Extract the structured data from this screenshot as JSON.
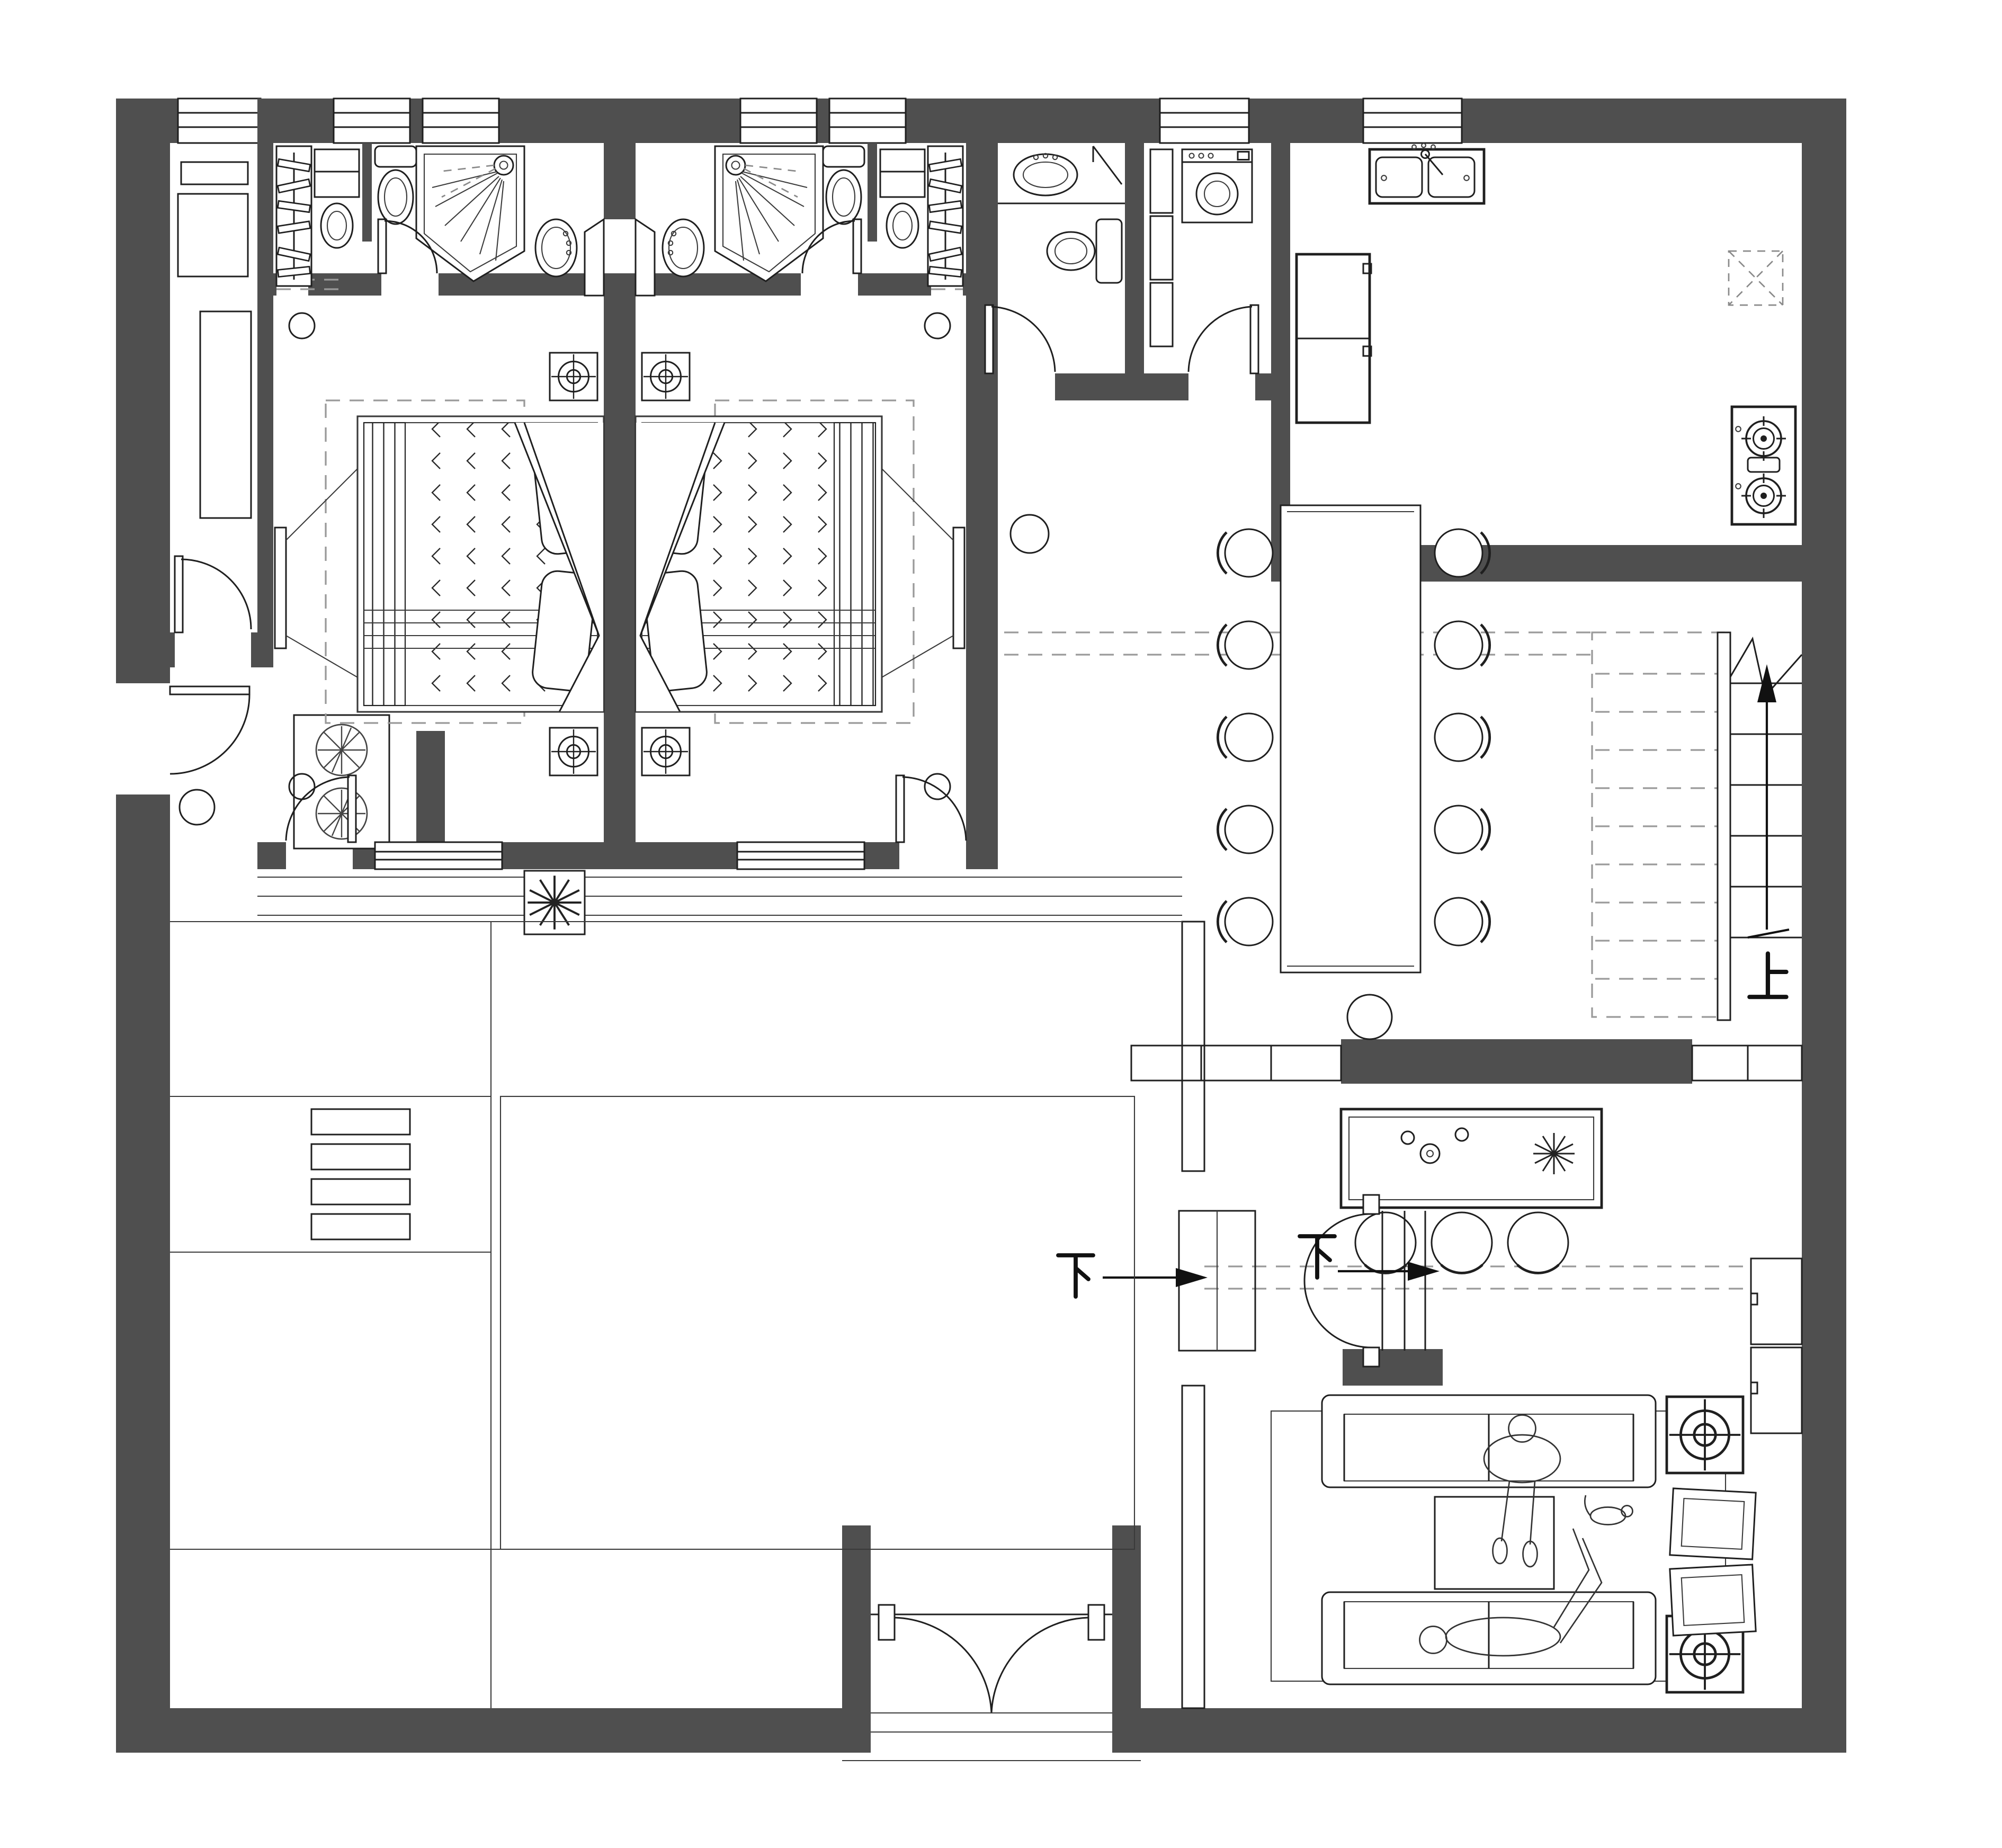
{
  "title": "Residential ground floor plan",
  "drawing_type": "architectural-floor-plan",
  "palette": {
    "wall": "#4f4f4f",
    "line": "#1f1f1f",
    "light_line": "#9a9a9a",
    "background": "#ffffff"
  },
  "labels": {
    "stairs_up": "上",
    "stairs_down": "下"
  },
  "annotations": [
    {
      "name": "stairs-up-arrow",
      "label": "上",
      "direction": "up"
    },
    {
      "name": "stairs-down-arrow-west",
      "label": "下",
      "direction": "down"
    },
    {
      "name": "stairs-down-arrow-east",
      "label": "下",
      "direction": "down"
    }
  ],
  "rooms": [
    {
      "name": "study",
      "fixtures": [
        "desk",
        "long-cabinet",
        "swing-door"
      ]
    },
    {
      "name": "entry-vestibule-west",
      "fixtures": [
        "swing-door",
        "planter-two-plants",
        "ceiling-light"
      ]
    },
    {
      "name": "walk-in-closet-left",
      "fixtures": [
        "hanging-rail",
        "clothes-hangers"
      ]
    },
    {
      "name": "bathroom-left",
      "fixtures": [
        "concealed-cistern-toilet",
        "tank-toilet",
        "corner-shower",
        "washbasin",
        "swing-door",
        "service-hatch"
      ]
    },
    {
      "name": "bathroom-right",
      "fixtures": [
        "corner-shower",
        "tank-toilet",
        "concealed-cistern-toilet",
        "washbasin",
        "swing-door",
        "service-hatch"
      ]
    },
    {
      "name": "walk-in-closet-right",
      "fixtures": [
        "hanging-rail",
        "clothes-hangers"
      ]
    },
    {
      "name": "bedroom-left",
      "fixtures": [
        "double-bed",
        "pillows",
        "nightstand-lamp",
        "nightstand-lamp",
        "tv-panel",
        "dashed-rug",
        "ceiling-light",
        "terrace-door",
        "window"
      ]
    },
    {
      "name": "bedroom-right",
      "fixtures": [
        "double-bed",
        "pillows",
        "nightstand-lamp",
        "nightstand-lamp",
        "tv-panel",
        "dashed-rug",
        "ceiling-light",
        "terrace-door",
        "window"
      ]
    },
    {
      "name": "hall-bathroom",
      "fixtures": [
        "washbasin",
        "toilet",
        "corner-shelf",
        "swing-door"
      ]
    },
    {
      "name": "laundry",
      "fixtures": [
        "washing-machine",
        "cabinet-stack",
        "swing-door"
      ]
    },
    {
      "name": "kitchen",
      "fixtures": [
        "double-bowl-sink",
        "refrigerator",
        "gas-hob-two-burner",
        "extractor-hood",
        "swing-door"
      ]
    },
    {
      "name": "dining",
      "fixtures": [
        "long-table",
        "chairs-x10",
        "pendant-light"
      ]
    },
    {
      "name": "staircase-up",
      "fixtures": [
        "solid-treads",
        "dashed-upper-flight",
        "handrail",
        "direction-arrow",
        "break-line"
      ]
    },
    {
      "name": "island-bar",
      "fixtures": [
        "island-counter",
        "bar-stools-x3",
        "pendant-light",
        "tap-fittings",
        "flower"
      ]
    },
    {
      "name": "staircase-down",
      "fixtures": [
        "double-swing-doors",
        "treads",
        "direction-arrows-x2",
        "shaft"
      ]
    },
    {
      "name": "living",
      "fixtures": [
        "sofa",
        "sofa",
        "coffee-table",
        "rug",
        "side-table-lamp",
        "side-table-lamp",
        "accent-chair",
        "accent-chair",
        "wall-cabinets",
        "person-sitting",
        "person-lying",
        "pet"
      ]
    },
    {
      "name": "courtyard",
      "fixtures": [
        "paving-lines",
        "bench-planters-x4",
        "planting-bed",
        "veranda-steps",
        "plant-box"
      ]
    },
    {
      "name": "entrance",
      "fixtures": [
        "double-entry-door",
        "threshold-steps"
      ]
    }
  ],
  "windows": {
    "top_wall_count": 7,
    "bedroom_wall_count": 2
  },
  "doors": {
    "interior_count": 12,
    "entrance_double_doors": 1
  }
}
